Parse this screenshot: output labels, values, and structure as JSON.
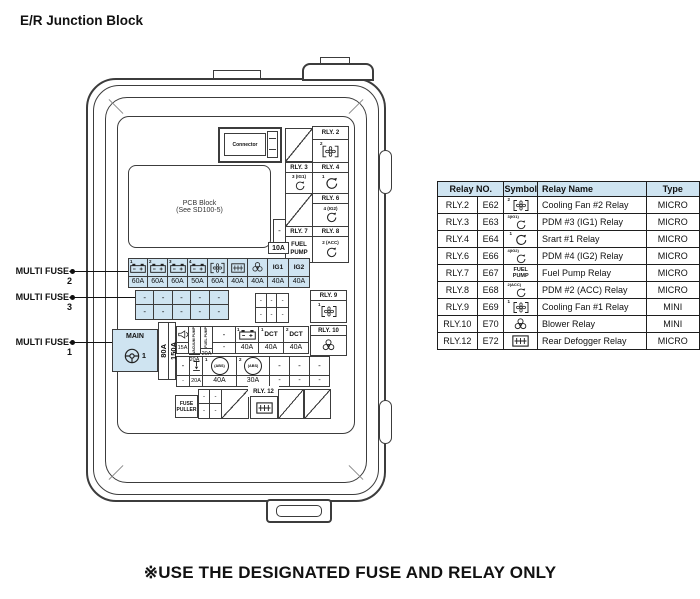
{
  "title": "E/R Junction Block",
  "footer_note": "※USE THE DESIGNATED FUSE AND RELAY ONLY",
  "colors": {
    "cell_blue": "#cfe4f1",
    "line": "#3c3c3c"
  },
  "diagram": {
    "connector": "Connector",
    "pcb_line1": "PCB Block",
    "pcb_line2": "(See SD100-5)",
    "multi_fuse_2": "MULTI FUSE-2",
    "multi_fuse_3": "MULTI FUSE-3",
    "multi_fuse_1": "MULTI FUSE-1",
    "main_label": "MAIN",
    "main_num": "1",
    "main_amp_1": "80A",
    "main_amp_2": "150A",
    "fuse_puller_1": "FUSE",
    "fuse_puller_2": "PULLER",
    "spare_fuse_amp": "10A",
    "dash": "-",
    "relays": {
      "rly2_label": "RLY. 2",
      "rly2_num": "2",
      "rly3_label": "RLY. 3",
      "rly3_num": "3",
      "rly3_sub": "(IG1)",
      "rly4_label": "RLY. 4",
      "rly4_num": "1",
      "rly6_label": "RLY. 6",
      "rly6_num": "4",
      "rly6_sub": "(IG2)",
      "rly7_label": "RLY. 7",
      "rly7_sym1": "FUEL",
      "rly7_sym2": "PUMP",
      "rly8_label": "RLY. 8",
      "rly8_num": "2",
      "rly8_sub": "(ACC)",
      "rly9_label": "RLY. 9",
      "rly9_num": "1",
      "rly10_label": "RLY. 10",
      "rly12_label": "RLY. 12"
    },
    "fuse_row_top": {
      "nums": [
        "1",
        "2",
        "3",
        "4"
      ],
      "ig1": "IG1",
      "ig2": "IG2",
      "amps": [
        "60A",
        "60A",
        "60A",
        "50A",
        "60A",
        "40A",
        "40A",
        "40A",
        "40A"
      ]
    },
    "small_row_1": {
      "vacuum_pump": "VACUUM PUMP",
      "fuel_pump": "FUEL PUMP",
      "battery_num": "1",
      "dct1_num": "1",
      "dct1": "DCT",
      "dct2_num": "2",
      "dct2": "DCT",
      "amps": [
        "15A",
        "20A",
        "20A",
        "-",
        "40A",
        "40A",
        "40A"
      ]
    },
    "small_row_2": {
      "abs_label": "(ABS)",
      "abs1_num": "1",
      "abs2_num": "2",
      "amps": [
        "-",
        "20A",
        "40A",
        "30A",
        "-",
        "-",
        "-"
      ]
    }
  },
  "table": {
    "header_relay_no": "Relay NO.",
    "header_symbol": "Symbol",
    "header_name": "Relay Name",
    "header_type": "Type",
    "rows": [
      {
        "no": "RLY.2",
        "code": "E62",
        "sym_num": "2",
        "sym_sub": "",
        "name": "Cooling Fan #2 Relay",
        "type": "MICRO"
      },
      {
        "no": "RLY.3",
        "code": "E63",
        "sym_num": "3",
        "sym_sub": "(IG1)",
        "name": "PDM #3 (IG1) Relay",
        "type": "MICRO"
      },
      {
        "no": "RLY.4",
        "code": "E64",
        "sym_num": "1",
        "sym_sub": "",
        "name": "Srart #1 Relay",
        "type": "MICRO"
      },
      {
        "no": "RLY.6",
        "code": "E66",
        "sym_num": "4",
        "sym_sub": "(IG2)",
        "name": "PDM #4 (IG2) Relay",
        "type": "MICRO"
      },
      {
        "no": "RLY.7",
        "code": "E67",
        "sym_text_1": "FUEL",
        "sym_text_2": "PUMP",
        "name": "Fuel Pump Relay",
        "type": "MICRO"
      },
      {
        "no": "RLY.8",
        "code": "E68",
        "sym_num": "2",
        "sym_sub": "(ACC)",
        "name": "PDM #2 (ACC) Relay",
        "type": "MICRO"
      },
      {
        "no": "RLY.9",
        "code": "E69",
        "sym_num": "1",
        "sym_sub": "",
        "name": "Cooling Fan #1 Relay",
        "type": "MINI"
      },
      {
        "no": "RLY.10",
        "code": "E70",
        "name": "Blower Relay",
        "type": "MINI"
      },
      {
        "no": "RLY.12",
        "code": "E72",
        "name": "Rear Defogger Relay",
        "type": "MICRO"
      }
    ]
  }
}
